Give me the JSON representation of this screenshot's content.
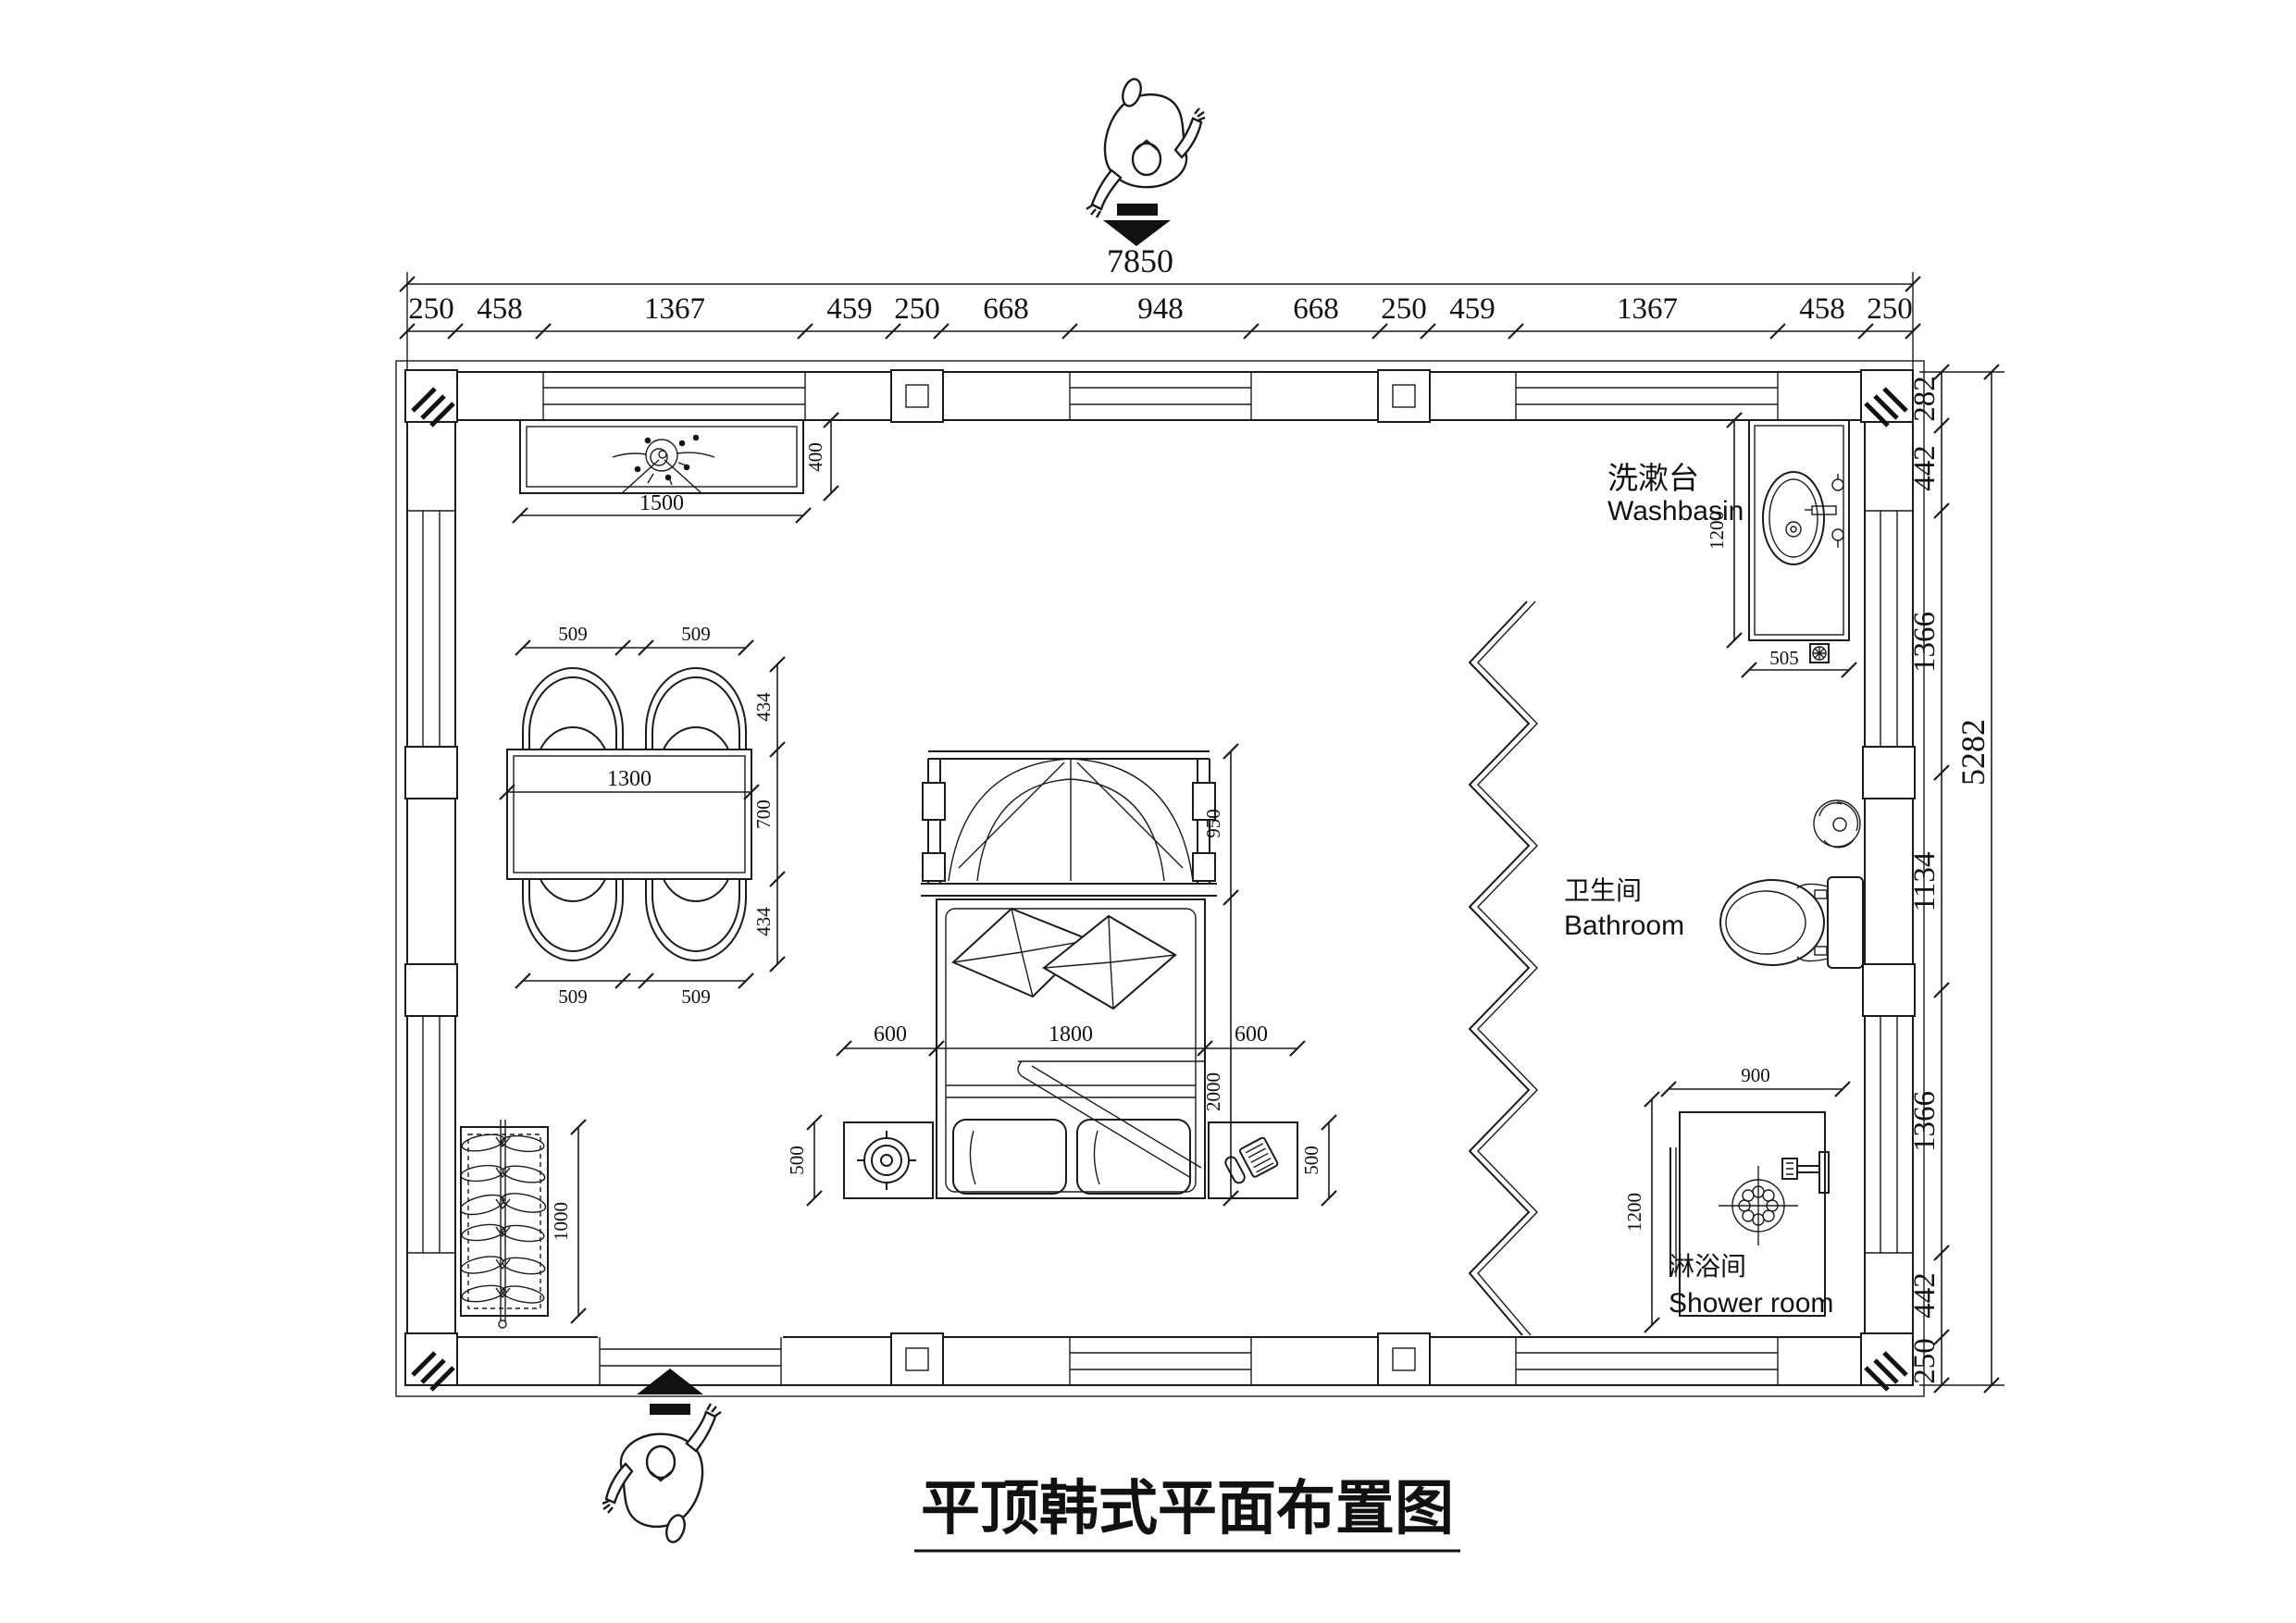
{
  "title": "平顶韩式平面布置图",
  "dims": {
    "top_total": "7850",
    "top": [
      "250",
      "458",
      "1367",
      "459",
      "250",
      "668",
      "948",
      "668",
      "250",
      "459",
      "1367",
      "458",
      "250"
    ],
    "right": [
      "282",
      "442",
      "1366",
      "1134",
      "1366",
      "442",
      "250"
    ],
    "right_total": "5282"
  },
  "labels": {
    "washbasin_zh": "洗漱台",
    "washbasin_en": "Washbasin",
    "bathroom_zh": "卫生间",
    "bathroom_en": "Bathroom",
    "shower_zh": "淋浴间",
    "shower_en": "Shower room"
  },
  "furniture_dims": {
    "console_width": "1500",
    "console_depth": "400",
    "chair_width": "509",
    "chair_depth": "434",
    "table_width": "1300",
    "table_depth": "700",
    "wardrobe_length": "1000",
    "bench_depth": "950",
    "bed_width": "1800",
    "bed_length": "2000",
    "nightstand_width": "600",
    "nightstand_depth": "500",
    "washbasin_counter": "1200",
    "washbasin_drain": "505",
    "shower_width": "900",
    "shower_depth": "1200"
  }
}
